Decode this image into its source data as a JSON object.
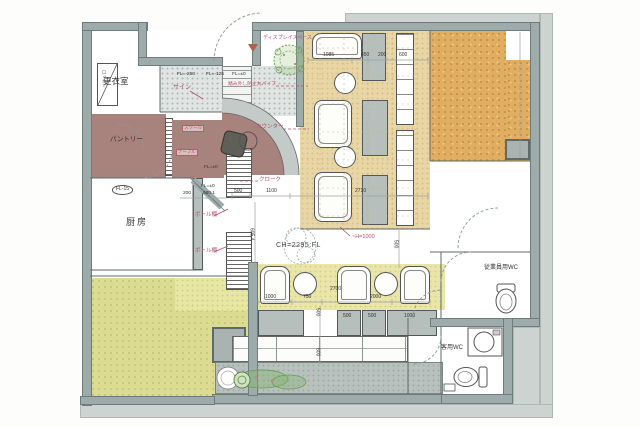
{
  "rooms": {
    "changing": "更衣室",
    "locker": "ロッカー",
    "pantry": "パントリー",
    "kitchen": "厨房",
    "employee_wc": "従業員用WC",
    "customer_wc": "客用WC"
  },
  "annotations": {
    "display_space": "ディスプレイスペース",
    "sign": "サイン",
    "pipe_guard": "踏み外し防止丸パイプ",
    "counter": "カウンター",
    "cloak": "クローク",
    "bottle_shelf": "ボトル棚",
    "stool": "スツール",
    "low_table": "テーブル",
    "ceiling": "CH=2295:FL",
    "handrail_height": "~H=1000"
  },
  "levels": {
    "step1": "FL=-250",
    "step2": "FL=-125",
    "step3": "FL=±0",
    "wait": "FL=±0",
    "cloak": "FL=±0",
    "kitchen": "FL-15"
  },
  "dims": {
    "lounge_top": [
      "1085",
      "450",
      "200",
      "600"
    ],
    "hall": [
      "500",
      "1100",
      "2710"
    ],
    "hall_v": [
      "605.4",
      "500"
    ],
    "cloak": [
      "200",
      "680.1"
    ],
    "booth": [
      "1000",
      "750",
      "2700",
      "2000"
    ],
    "booth_tables": [
      "500",
      "500",
      "1000"
    ],
    "booth_v": [
      "500",
      "600"
    ]
  }
}
